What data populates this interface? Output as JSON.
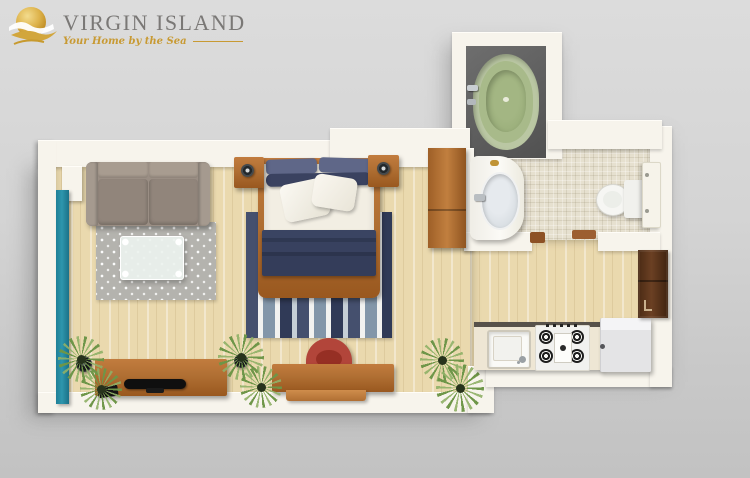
{
  "logo": {
    "title": "VIRGIN ISLAND",
    "tagline": "Your Home by the Sea",
    "icon": "sun-waves-icon"
  },
  "palette": {
    "background_top": "#dcdcdc",
    "background_bottom": "#c2c2c2",
    "wall": "#f7f4ec",
    "wood_floor": "#ead9ae",
    "tile_floor": "#e6e0cf",
    "wood_furniture": "#b06f33",
    "sofa_taupe": "#9a8e84",
    "rug_gray": "#b4b3ae",
    "rug_navy": "#45506e",
    "rug_blue": "#8396a9",
    "bed_white": "#f2eee3",
    "blanket_navy": "#343d5a",
    "pillow_navy": "#5f6788",
    "chair_red": "#b2453a",
    "curtain_teal": "#2d96ad",
    "tub_green": "#a8ba8a",
    "tub_platform": "#5f5f5f",
    "plant_green": "#7ca355",
    "cabinet_brown": "#533018",
    "appliance_white": "#f1f1ef",
    "counter_cream": "#eee6d4",
    "logo_gold": "#c89a33",
    "logo_gray": "#7a7876"
  },
  "floorplan": {
    "view": "3d-top-down-studio-apartment",
    "rooms": [
      "living-area",
      "sleeping-area",
      "bathroom",
      "kitchen"
    ],
    "furniture": [
      "sofa",
      "coffee-table",
      "dotted-rug",
      "tv-console",
      "tv",
      "speaker",
      "av-receiver",
      "desk",
      "desk-chair",
      "double-bed",
      "nightstand",
      "table-lamp",
      "striped-rug",
      "wardrobe",
      "window-curtain",
      "potted-plant",
      "bathtub",
      "pedestal-sink",
      "toilet",
      "door-panel",
      "door-threshold",
      "kitchen-counter",
      "kitchen-sink",
      "gas-stove",
      "refrigerator",
      "tall-cabinet"
    ]
  }
}
